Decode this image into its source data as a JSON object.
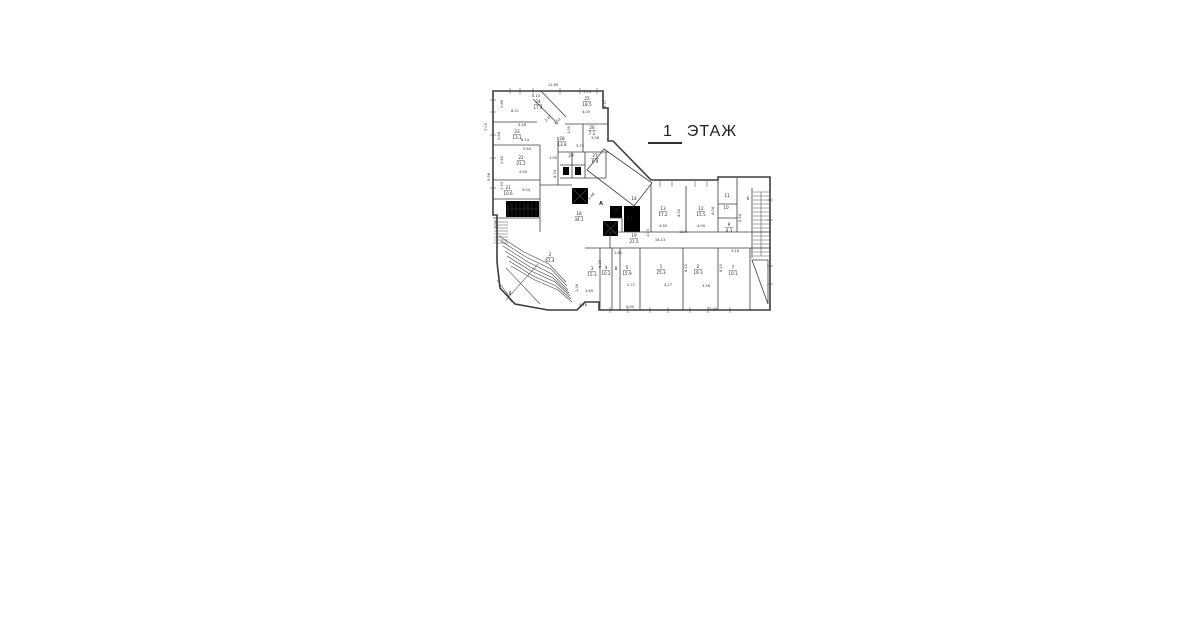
{
  "title": {
    "num": "1",
    "word": "ЭТАЖ"
  },
  "colors": {
    "line": "#3d3d3d",
    "hatch": "#8c8c8c",
    "paper": "#ffffff"
  },
  "plan": {
    "rooms": [
      {
        "n": "24",
        "a": "17.4",
        "x": 538,
        "y": 103
      },
      {
        "n": "25",
        "a": "18.5",
        "x": 587,
        "y": 100
      },
      {
        "n": "23",
        "a": "13.1",
        "x": 517,
        "y": 133
      },
      {
        "n": "26",
        "a": "7.1",
        "x": 592,
        "y": 129
      },
      {
        "n": "28",
        "a": "13.8",
        "x": 562,
        "y": 140
      },
      {
        "n": "22",
        "a": "21.2",
        "x": 521,
        "y": 159
      },
      {
        "n": "29",
        "a": "",
        "x": 571,
        "y": 157
      },
      {
        "n": "27",
        "a": "6.9",
        "x": 595,
        "y": 157
      },
      {
        "n": "21",
        "a": "10.6",
        "x": 508,
        "y": 189
      },
      {
        "n": "20",
        "a": "",
        "x": 527,
        "y": 208
      },
      {
        "n": "18",
        "a": "34.1",
        "x": 579,
        "y": 215
      },
      {
        "n": "14",
        "a": "",
        "x": 634,
        "y": 200
      },
      {
        "n": "16",
        "a": "",
        "x": 616,
        "y": 212
      },
      {
        "n": "17",
        "a": "",
        "x": 630,
        "y": 220
      },
      {
        "n": "13",
        "a": "17.2",
        "x": 663,
        "y": 210
      },
      {
        "n": "12",
        "a": "15.5",
        "x": 701,
        "y": 210
      },
      {
        "n": "11",
        "a": "",
        "x": 727,
        "y": 197
      },
      {
        "n": "10",
        "a": "",
        "x": 726,
        "y": 209
      },
      {
        "n": "6",
        "a": "",
        "x": 748,
        "y": 200
      },
      {
        "n": "9",
        "a": "4.3",
        "x": 729,
        "y": 226
      },
      {
        "n": "19",
        "a": "21.5",
        "x": 634,
        "y": 237
      },
      {
        "n": "3",
        "a": "15.3",
        "x": 592,
        "y": 270
      },
      {
        "n": "4",
        "a": "10.2",
        "x": 606,
        "y": 269
      },
      {
        "n": "8",
        "a": "",
        "x": 616,
        "y": 270
      },
      {
        "n": "5",
        "a": "15.9",
        "x": 627,
        "y": 269
      },
      {
        "n": "1",
        "a": "25.3",
        "x": 661,
        "y": 268
      },
      {
        "n": "2",
        "a": "19.3",
        "x": 698,
        "y": 268
      },
      {
        "n": "7",
        "a": "10.1",
        "x": 733,
        "y": 269
      },
      {
        "n": "2",
        "a": "61.4",
        "x": 550,
        "y": 256
      }
    ],
    "dims": [
      {
        "t": "12.89",
        "x": 553,
        "y": 86
      },
      {
        "t": "7.03",
        "x": 487,
        "y": 127,
        "r": -90
      },
      {
        "t": "5.98",
        "x": 490,
        "y": 177,
        "r": -90
      },
      {
        "t": "4.79",
        "x": 497,
        "y": 224,
        "r": -90
      },
      {
        "t": "6.10",
        "x": 536,
        "y": 97
      },
      {
        "t": "2.86",
        "x": 503,
        "y": 104,
        "r": -90
      },
      {
        "t": "8.51",
        "x": 515,
        "y": 112
      },
      {
        "t": "3.48",
        "x": 522,
        "y": 126
      },
      {
        "t": "2.84",
        "x": 500,
        "y": 136,
        "r": -90
      },
      {
        "t": "6.14",
        "x": 525,
        "y": 141
      },
      {
        "t": "5.84",
        "x": 527,
        "y": 150
      },
      {
        "t": "3.52",
        "x": 503,
        "y": 160,
        "r": -90
      },
      {
        "t": "4.50",
        "x": 523,
        "y": 173
      },
      {
        "t": "1.93",
        "x": 503,
        "y": 186,
        "r": -90
      },
      {
        "t": "5.04",
        "x": 526,
        "y": 191
      },
      {
        "t": "5.74",
        "x": 587,
        "y": 93
      },
      {
        "t": "3.37",
        "x": 606,
        "y": 104,
        "r": -90
      },
      {
        "t": "4.05",
        "x": 586,
        "y": 113
      },
      {
        "t": "2.47",
        "x": 549,
        "y": 119,
        "r": -45
      },
      {
        "t": "2.52",
        "x": 558,
        "y": 122,
        "r": -45
      },
      {
        "t": "1.90",
        "x": 570,
        "y": 130,
        "r": -90
      },
      {
        "t": "3.06",
        "x": 595,
        "y": 139
      },
      {
        "t": "3.73",
        "x": 580,
        "y": 147
      },
      {
        "t": "1.55",
        "x": 553,
        "y": 159
      },
      {
        "t": "4.74",
        "x": 556,
        "y": 174,
        "r": -90
      },
      {
        "t": "2.46",
        "x": 592,
        "y": 197,
        "r": -45
      },
      {
        "t": "4.35",
        "x": 663,
        "y": 227
      },
      {
        "t": "4.92",
        "x": 680,
        "y": 213,
        "r": -90
      },
      {
        "t": "4.00",
        "x": 701,
        "y": 227
      },
      {
        "t": "4.04",
        "x": 714,
        "y": 211,
        "r": -90
      },
      {
        "t": "13.9",
        "x": 683,
        "y": 233
      },
      {
        "t": "1.03",
        "x": 649,
        "y": 233,
        "r": -90
      },
      {
        "t": "16.13",
        "x": 660,
        "y": 241
      },
      {
        "t": "2.54",
        "x": 741,
        "y": 218,
        "r": -90
      },
      {
        "t": "3.18",
        "x": 735,
        "y": 252
      },
      {
        "t": "2.60",
        "x": 618,
        "y": 254
      },
      {
        "t": "6.29",
        "x": 601,
        "y": 264,
        "r": -90
      },
      {
        "t": "2.71",
        "x": 631,
        "y": 286
      },
      {
        "t": "4.17",
        "x": 668,
        "y": 286
      },
      {
        "t": "3.28",
        "x": 706,
        "y": 287
      },
      {
        "t": "6.12",
        "x": 687,
        "y": 268,
        "r": -90
      },
      {
        "t": "6.10",
        "x": 722,
        "y": 268,
        "r": -90
      },
      {
        "t": "3.69",
        "x": 589,
        "y": 292
      },
      {
        "t": "1.26",
        "x": 578,
        "y": 288,
        "r": -90
      },
      {
        "t": "4.78",
        "x": 583,
        "y": 306
      },
      {
        "t": "5.90",
        "x": 630,
        "y": 308
      },
      {
        "t": "13.44",
        "x": 712,
        "y": 310
      }
    ],
    "letters": [
      {
        "t": "А",
        "x": 601,
        "y": 205
      },
      {
        "t": "I",
        "x": 510,
        "y": 295
      }
    ]
  }
}
